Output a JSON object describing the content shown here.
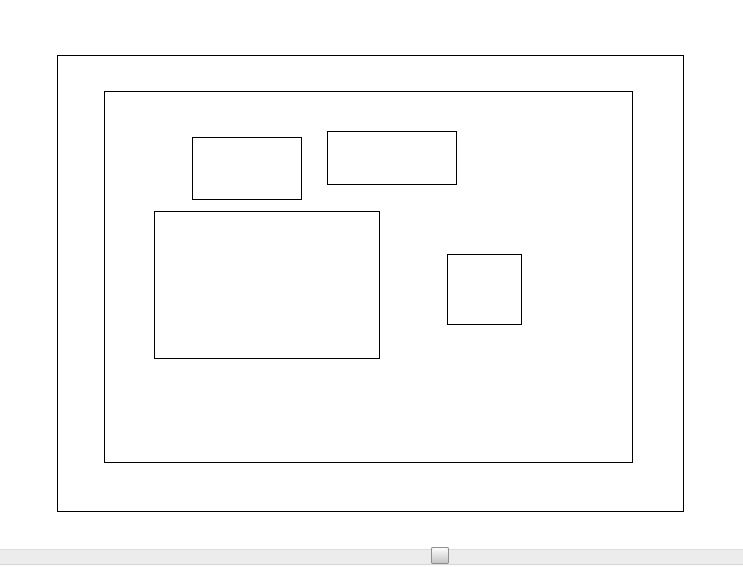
{
  "canvas": {
    "background_color": "#ffffff",
    "stroke_color": "#000000",
    "stroke_width_px": 1.3,
    "shapes": [
      {
        "name": "outer-frame-rect",
        "x": 57,
        "y": 55,
        "w": 627,
        "h": 457
      },
      {
        "name": "inner-frame-rect",
        "x": 104,
        "y": 91,
        "w": 529,
        "h": 372
      },
      {
        "name": "small-rect-top-left",
        "x": 192,
        "y": 137,
        "w": 110,
        "h": 63
      },
      {
        "name": "small-rect-top-right",
        "x": 327,
        "y": 131,
        "w": 130,
        "h": 54
      },
      {
        "name": "large-rect-middle",
        "x": 154,
        "y": 211,
        "w": 226,
        "h": 148
      },
      {
        "name": "small-square-right",
        "x": 447,
        "y": 254,
        "w": 75,
        "h": 71
      }
    ]
  },
  "scrollbar": {
    "orientation": "horizontal",
    "track": {
      "x": 0,
      "y": 549,
      "w": 743,
      "h": 16,
      "fill_color": "#ececec",
      "border_top_color": "#dcdcdc",
      "border_bottom_color": "#d6d6d6"
    },
    "thumb": {
      "x": 431,
      "y": 547,
      "w": 18,
      "h": 17,
      "border_color": "#8f8f8f",
      "fill_top_color": "#fdfdfd",
      "fill_bottom_color": "#c6c6c6"
    }
  }
}
